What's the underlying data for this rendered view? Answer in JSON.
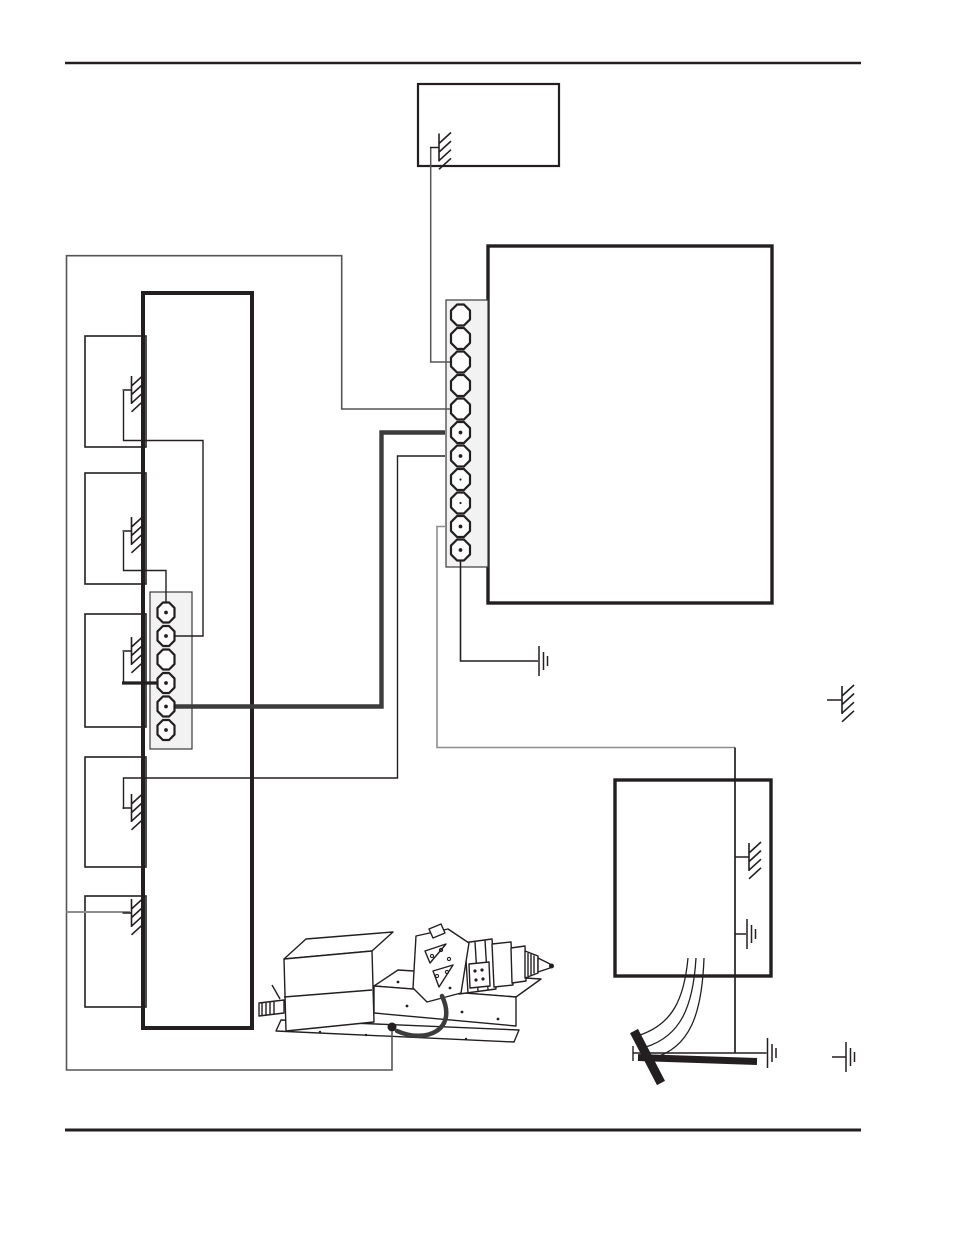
{
  "page": {
    "width": 954,
    "height": 1235,
    "background": "#ffffff"
  },
  "colors": {
    "ink": "#231f20",
    "mid": "#555555",
    "gray": "#8e8e8e",
    "bold": "#3c3c3c",
    "strip_fill": "#f2f2f2",
    "white": "#ffffff"
  },
  "rules": [
    {
      "name": "header-rule",
      "x1": 65,
      "x2": 861,
      "y": 63,
      "w": 2.4
    },
    {
      "name": "footer-rule",
      "x1": 65,
      "x2": 861,
      "y": 1130,
      "w": 3
    }
  ],
  "boxes": [
    {
      "name": "top-center-box",
      "x": 418,
      "y": 84,
      "w": 141,
      "h": 82,
      "stroke": 2.2
    },
    {
      "name": "right-large-box",
      "x": 488,
      "y": 246,
      "w": 284,
      "h": 357,
      "stroke": 3.4
    },
    {
      "name": "left-tall-box",
      "x": 143,
      "y": 293,
      "w": 109,
      "h": 735,
      "stroke": 4
    },
    {
      "name": "left-box-1",
      "x": 85,
      "y": 336,
      "w": 61,
      "h": 111,
      "stroke": 1.6
    },
    {
      "name": "left-box-2",
      "x": 85,
      "y": 473,
      "w": 61,
      "h": 111,
      "stroke": 1.6
    },
    {
      "name": "left-box-3",
      "x": 85,
      "y": 614,
      "w": 61,
      "h": 113,
      "stroke": 1.6
    },
    {
      "name": "left-box-4",
      "x": 85,
      "y": 757,
      "w": 61,
      "h": 110,
      "stroke": 1.6
    },
    {
      "name": "left-box-5",
      "x": 85,
      "y": 896,
      "w": 61,
      "h": 111,
      "stroke": 1.6
    },
    {
      "name": "bottom-right-box",
      "x": 615,
      "y": 780,
      "w": 156,
      "h": 196,
      "stroke": 3.4
    }
  ],
  "strips": [
    {
      "name": "left-connector-strip",
      "x": 150,
      "y": 592,
      "w": 42,
      "h": 157,
      "cx": 166,
      "tw": 17,
      "th": 20,
      "terminals": [
        {
          "y": 612.5,
          "dot": "big"
        },
        {
          "y": 636,
          "dot": "big"
        },
        {
          "y": 659.5,
          "dot": "none"
        },
        {
          "y": 683,
          "dot": "big"
        },
        {
          "y": 706.5,
          "dot": "big"
        },
        {
          "y": 730,
          "dot": "big"
        }
      ]
    },
    {
      "name": "right-terminal-strip",
      "x": 446,
      "y": 300,
      "w": 42,
      "h": 267,
      "cx": 460.5,
      "tw": 19,
      "th": 21,
      "terminals": [
        {
          "y": 315,
          "dot": "none"
        },
        {
          "y": 338.5,
          "dot": "none"
        },
        {
          "y": 362,
          "dot": "none"
        },
        {
          "y": 385.5,
          "dot": "none"
        },
        {
          "y": 409,
          "dot": "none"
        },
        {
          "y": 432.5,
          "dot": "big"
        },
        {
          "y": 456,
          "dot": "big"
        },
        {
          "y": 479.5,
          "dot": "small"
        },
        {
          "y": 503,
          "dot": "small"
        },
        {
          "y": 526.5,
          "dot": "big"
        },
        {
          "y": 550,
          "dot": "big"
        }
      ]
    }
  ],
  "wires": [
    {
      "name": "wire-topbox-to-terminal3",
      "d": "M430.7,148 V362 H451",
      "w": 1.5,
      "c": "mid"
    },
    {
      "name": "wire-ground-loop-terminal5",
      "d": "M451,409 H341.7 V255.7 H66.5 V1070 H392 V1031",
      "w": 1.6,
      "c": "mid"
    },
    {
      "name": "wire-loop-branch-box5",
      "d": "M66.5,912 H130",
      "w": 1.9,
      "c": "gray"
    },
    {
      "name": "wire-box1-to-connector2",
      "d": "M123.5,391 V440.5 H203 V636 H174",
      "w": 1.4,
      "c": "ink"
    },
    {
      "name": "wire-box2-to-connector1",
      "d": "M123.5,532 V570.5 H166 V608",
      "w": 1.4,
      "c": "ink"
    },
    {
      "name": "wire-box3-to-connector4",
      "d": "M123.5,652 V683",
      "w": 1.4,
      "c": "ink"
    },
    {
      "name": "wire-box3-to-connector4-bold",
      "d": "M122,683 H161",
      "w": 3.2,
      "c": "ink"
    },
    {
      "name": "wire-connector5-to-terminal6",
      "d": "M166,706.5 H381.5 V432.5 H445",
      "w": 4.4,
      "c": "bold"
    },
    {
      "name": "wire-box4-to-terminal7",
      "d": "M123.5,809 V778 H397.5 V456 H445",
      "w": 1.4,
      "c": "ink"
    },
    {
      "name": "wire-terminal10-to-rod",
      "d": "M445,526.5 H437 V747.5 H735",
      "w": 1.6,
      "c": "gray"
    },
    {
      "name": "wire-rod-drop",
      "d": "M735,747.5 V1053",
      "w": 1.7,
      "c": "ink"
    },
    {
      "name": "wire-terminal11-to-ground",
      "d": "M460.5,560 V661 H538",
      "w": 1.6,
      "c": "ink"
    },
    {
      "name": "wire-rightbox-chassis-stub",
      "d": "M735,857 H740",
      "w": 1.5,
      "c": "ink"
    },
    {
      "name": "wire-rightbox-earth-stub",
      "d": "M735,934 H746",
      "w": 1.5,
      "c": "ink"
    },
    {
      "name": "wire-rod-bus",
      "d": "M633,1053 H766.5",
      "w": 1.4,
      "c": "ink"
    },
    {
      "name": "wire-rod-bus-tick",
      "d": "M633,1046 V1061",
      "w": 1.4,
      "c": "ink"
    },
    {
      "name": "ground-wire-curve-1",
      "d": "M688,958 C684,1000 672,1024 640,1035",
      "w": 1.3,
      "c": "ink"
    },
    {
      "name": "ground-wire-curve-2",
      "d": "M696,958 C693,1008 680,1036 646,1047",
      "w": 1.3,
      "c": "ink"
    },
    {
      "name": "ground-wire-curve-3",
      "d": "M704,958 C702,1014 690,1048 653,1058",
      "w": 1.3,
      "c": "ink"
    }
  ],
  "chassis_grounds": [
    {
      "name": "chassis-ground-topbox",
      "x": 439,
      "y": 147.5,
      "stub": 9
    },
    {
      "name": "chassis-ground-box1",
      "x": 131.5,
      "y": 390,
      "stub": 9
    },
    {
      "name": "chassis-ground-box2",
      "x": 131.5,
      "y": 531,
      "stub": 9
    },
    {
      "name": "chassis-ground-box3",
      "x": 131.5,
      "y": 651,
      "stub": 9
    },
    {
      "name": "chassis-ground-box4",
      "x": 131.5,
      "y": 808,
      "stub": 9
    },
    {
      "name": "chassis-ground-box5",
      "x": 131.5,
      "y": 913,
      "stub": 9
    },
    {
      "name": "chassis-ground-rightbox",
      "x": 749,
      "y": 857,
      "stub": 9
    },
    {
      "name": "chassis-ground-standalone-right",
      "x": 842,
      "y": 700,
      "stub": 15
    }
  ],
  "earth_grounds": [
    {
      "name": "earth-ground-terminal11",
      "x": 539,
      "y": 661
    },
    {
      "name": "earth-ground-rightbox",
      "x": 747,
      "y": 934
    },
    {
      "name": "earth-ground-rod",
      "x": 767.5,
      "y": 1053
    },
    {
      "name": "earth-ground-bottom-right",
      "x": 846,
      "y": 1057,
      "stub_from": 832
    }
  ],
  "ground_rod": {
    "rod": {
      "name": "ground-rod-bar",
      "d": "M638,1057.5 L757,1061.5",
      "w": 7
    },
    "clamp": {
      "name": "ground-rod-clamp",
      "d": "M634,1031 L661,1083",
      "w": 9
    }
  },
  "machine": [
    {
      "name": "feeder-base-plate",
      "d": "M281,1020 L519,1030 L514,1042 L276,1031 Z",
      "fill": "white"
    },
    {
      "name": "feeder-deck-top",
      "d": "M374,986 L398,970 L541,979 L516,997 Z",
      "fill": "white"
    },
    {
      "name": "feeder-deck-front",
      "d": "M374,986 L516,997 L516,1026 L374,1013 Z",
      "fill": "white"
    },
    {
      "name": "feeder-box-top",
      "d": "M284,959 L306,939 L393,932 L372,951 Z",
      "fill": "white"
    },
    {
      "name": "feeder-box-front",
      "d": "M284,959 L372,951 L374,1022 L286,1031 Z",
      "fill": "white"
    },
    {
      "name": "feeder-box-seam",
      "d": "M284,997 L372,990",
      "fill": "none"
    },
    {
      "name": "feeder-screw-block",
      "d": "M259,1003 L284,1000 L284,1013 L259,1016 Z",
      "fill": "white"
    },
    {
      "name": "feeder-screw-threads",
      "d": "M262,1003 V1015 M266,1002.6 V1014.6 M270,1002.2 V1014.2 M274,1001.8 V1013.8",
      "fill": "none"
    },
    {
      "name": "feeder-screw-knob",
      "d": "M272,985 L280,999",
      "fill": "none"
    },
    {
      "name": "gun-drum",
      "d": "M455,944 L492,939 L496,989 L459,994 Z",
      "fill": "white"
    },
    {
      "name": "gun-drum-ribs",
      "d": "M465,943 L468,993 M475,941.5 L478,991.5 M485,940 L488,990",
      "fill": "none"
    },
    {
      "name": "gun-ring",
      "d": "M492,944 L511,942 L513,985 L494,987 Z",
      "fill": "white"
    },
    {
      "name": "gun-collar",
      "d": "M511,948 L525,946 L526,981 L512,983 Z",
      "fill": "white"
    },
    {
      "name": "gun-nozzle",
      "d": "M525,951 L538,956 L538,973 L525,978 Z",
      "fill": "white"
    },
    {
      "name": "gun-nozzle-ribs",
      "d": "M528,953 V976 M531,954 V975 M534,955.5 V973.5",
      "fill": "none"
    },
    {
      "name": "gun-tip",
      "d": "M538,958 L550,964 L550,968 L538,972 Z",
      "fill": "white"
    },
    {
      "name": "gun-tip-ball",
      "c": [
        551.5,
        966,
        2.5
      ],
      "fill": "ink"
    },
    {
      "name": "bracket-plate",
      "d": "M416,936 L448,929 L469,943 L461,993 L427,1002 L413,988 Z",
      "fill": "white"
    },
    {
      "name": "bracket-tab",
      "d": "M429,929 L441,924 L445,933 L433,938 Z",
      "fill": "white"
    },
    {
      "name": "bracket-hole-upper",
      "d": "M425,951 L446,944 L430,963 Z",
      "fill": "white"
    },
    {
      "name": "bracket-hole-lower",
      "d": "M433,971 L453,965 L439,987 Z",
      "fill": "white"
    },
    {
      "name": "bracket-hole-a",
      "c": [
        432,
        956,
        1.6
      ],
      "fill": "none"
    },
    {
      "name": "bracket-hole-b",
      "c": [
        441,
        950,
        1.6
      ],
      "fill": "none"
    },
    {
      "name": "bracket-hole-c",
      "c": [
        449,
        959,
        1.6
      ],
      "fill": "none"
    },
    {
      "name": "bracket-hole-d",
      "c": [
        437,
        976,
        1.6
      ],
      "fill": "none"
    },
    {
      "name": "bracket-hole-e",
      "c": [
        447,
        972,
        1.6
      ],
      "fill": "none"
    },
    {
      "name": "gun-block",
      "d": "M469,964 L489,962 L490,986 L470,988 Z",
      "fill": "white"
    },
    {
      "name": "gun-block-pin-1",
      "c": [
        475,
        971,
        1.6
      ],
      "fill": "ink"
    },
    {
      "name": "gun-block-pin-2",
      "c": [
        482,
        970,
        1.6
      ],
      "fill": "ink"
    },
    {
      "name": "gun-block-pin-3",
      "c": [
        476,
        980,
        1.6
      ],
      "fill": "ink"
    },
    {
      "name": "gun-block-pin-4",
      "c": [
        483,
        979,
        1.6
      ],
      "fill": "ink"
    },
    {
      "name": "deck-hole-1",
      "c": [
        398,
        982,
        1.4
      ],
      "fill": "ink"
    },
    {
      "name": "deck-hole-2",
      "c": [
        407,
        1006,
        1.4
      ],
      "fill": "ink"
    },
    {
      "name": "deck-hole-3",
      "c": [
        450,
        988,
        1.4
      ],
      "fill": "ink"
    },
    {
      "name": "deck-hole-4",
      "c": [
        462,
        1012,
        1.4
      ],
      "fill": "ink"
    },
    {
      "name": "deck-hole-5",
      "c": [
        498,
        1019,
        1.4
      ],
      "fill": "ink"
    },
    {
      "name": "base-hole-1",
      "c": [
        320,
        1032,
        1.2
      ],
      "fill": "ink"
    },
    {
      "name": "base-hole-2",
      "c": [
        366,
        1035,
        1.2
      ],
      "fill": "ink"
    },
    {
      "name": "base-hole-3",
      "c": [
        420,
        1037,
        1.2
      ],
      "fill": "ink"
    },
    {
      "name": "base-hole-4",
      "c": [
        466,
        1039,
        1.2
      ],
      "fill": "ink"
    },
    {
      "name": "feeder-cable",
      "d": "M442,996 C458,1030 426,1044 397,1031",
      "fill": "none",
      "w": 4.5,
      "c": "bold"
    },
    {
      "name": "feeder-cable-ground-dot",
      "c": [
        392,
        1027,
        4.5
      ],
      "fill": "ink"
    }
  ]
}
